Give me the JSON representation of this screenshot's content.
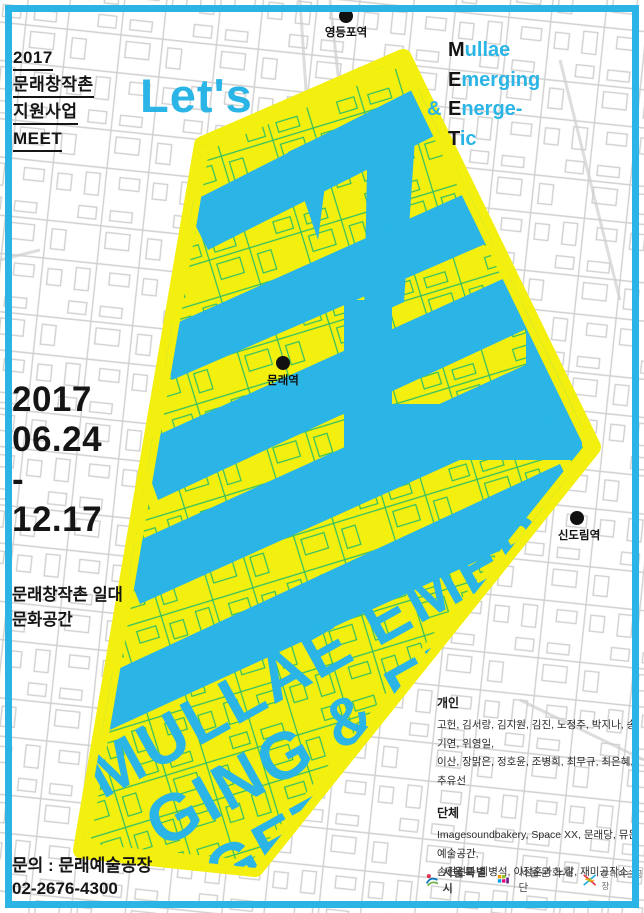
{
  "program": {
    "line1": "2017",
    "line2": "문래창작촌",
    "line3": "지원사업",
    "line4": "MEET"
  },
  "headline": "Let's",
  "acronym": [
    {
      "prefix": "",
      "initial": "M",
      "rest": "ullae"
    },
    {
      "prefix": "",
      "initial": "E",
      "rest": "merging"
    },
    {
      "prefix": "&",
      "initial": "E",
      "rest": "nerge-"
    },
    {
      "prefix": "",
      "initial": "T",
      "rest": "ic"
    }
  ],
  "dates": {
    "year": "2017",
    "start": "06.24",
    "separator": "-",
    "end": "12.17"
  },
  "venue": {
    "line1": "문래창작촌 일대",
    "line2": "문화공간"
  },
  "stations": {
    "yeongdeungpo": "영등포역",
    "mullae": "문래역",
    "sindorim": "신도림역"
  },
  "big_text": {
    "line1": "MULLAE EMER",
    "line2": "GING & ENER",
    "line3": "GETIC"
  },
  "participants": {
    "individual_title": "개인",
    "individual_line1": "고헌, 김서랑, 김지원, 김진, 노정주, 박지나, 송기연, 위영일,",
    "individual_line2": "이산, 장맑은, 정호윤, 조병희, 최무규, 최은혜, 추유선",
    "group_title": "단체",
    "group_line1": "Imagesoundbakery, Space XX, 문래당, 뮤온 예술공간,",
    "group_line2": "손현선과 최병석, 이정훈과 노갈, 재미공작소"
  },
  "contact": {
    "line1": "문의 : 문래예술공장",
    "line2": "02-2676-4300"
  },
  "logos": [
    {
      "name": "서울특별시"
    },
    {
      "name": "서울문화재단"
    },
    {
      "name": "문래예술공장"
    }
  ],
  "colors": {
    "accent_cyan": "#2ab5e6",
    "accent_yellow": "#f3ef0f",
    "map_line_gray": "#d0d0d0",
    "map_line_green": "#2fbf63",
    "text_black": "#151515"
  }
}
